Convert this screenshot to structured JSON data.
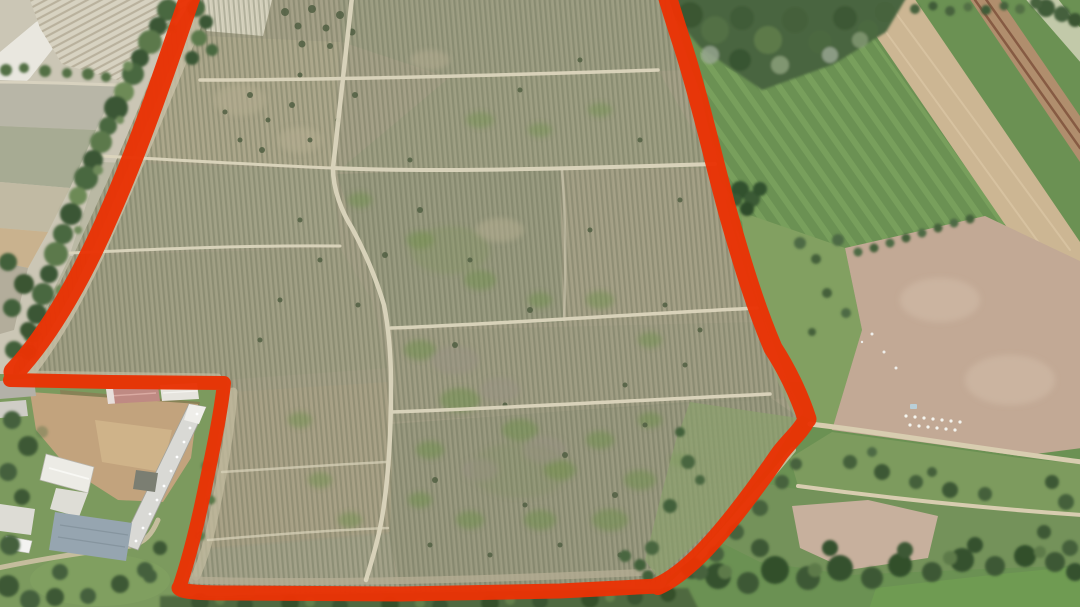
{
  "scene": {
    "type": "aerial-drone-photo",
    "subject": "Large farm parcel with vineyard blocks outlined by a thick hand-drawn red boundary",
    "ground_features": [
      "vineyard rows arranged in rectangular blocks separated by dirt paths",
      "pale plowed fields on the left",
      "green grass fields with diagonal mowing stripes on the right",
      "wide tan dirt strip and bare brown fields on the right",
      "tree lines along the boundary and riparian woodland at bottom right",
      "farm buildings with white, pink and blue-gray roofs at bottom left, excluded from the parcel by a notch",
      "rows of beehives on the bare field at mid right"
    ],
    "visible_text": ""
  },
  "annotation": {
    "description": "red boundary outline around the parcel, open at the top edge of the frame; a rectangular notch at lower left excludes the farm buildings",
    "color": "#e93305",
    "paths": {
      "left_line": "M193,-12 C168,62 141,142 110,212 C86,268 52,332 14,372",
      "notch": "M14,372 L10,380 L110,382 L224,383 C221,412 213,450 205,488 C198,522 190,556 179,588",
      "bottom_band": "M179,588 C182,592 200,593 230,593 L400,594 L560,591 L658,586",
      "curve": "M658,586 C676,578 696,560 712,542 C736,515 758,485 780,453 C792,438 801,431 807,419",
      "right_line": "M807,419 C799,394 786,368 773,348 C756,308 743,266 728,213 C716,170 705,120 689,66 C682,42 672,14 665,-12"
    },
    "stroke_widths": {
      "left_line": 21,
      "notch": 14,
      "bottom_band": 15,
      "curve": 18,
      "right_line": 19
    }
  },
  "palette": {
    "vineyard_olive": "#a29e85",
    "vine_row_line": "#686c55",
    "dirt_path": "#dcd5bd",
    "plowed_pale": "#d7d2c1",
    "grass_green": "#6b9153",
    "bare_tan": "#ccb693",
    "bare_pink": "#c2a995",
    "tree_dark_green": "#45613c",
    "roof_white": "#e6e4de",
    "roof_pink": "#bf8a83",
    "roof_blue_gray": "#96a5b0"
  }
}
